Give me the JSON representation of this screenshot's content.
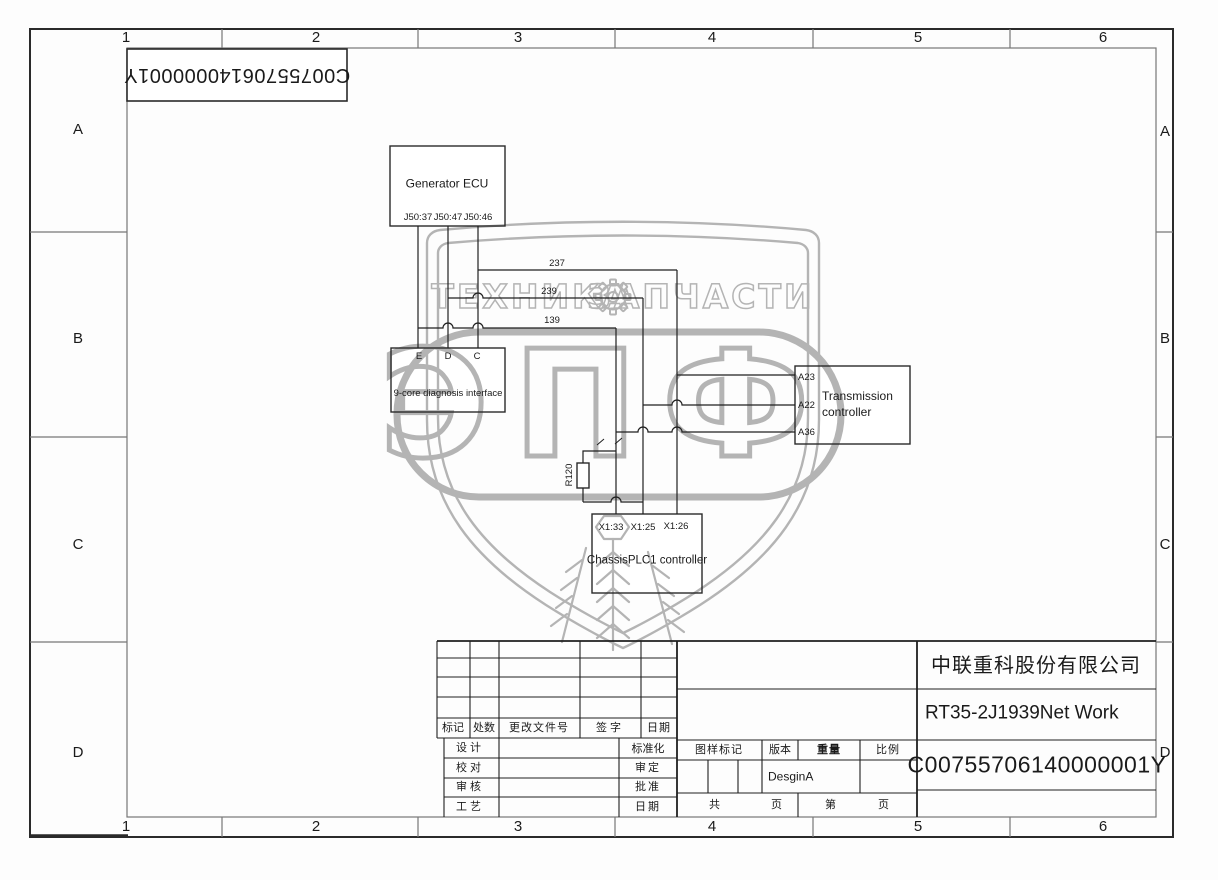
{
  "zones": {
    "cols": [
      "1",
      "2",
      "3",
      "4",
      "5",
      "6"
    ],
    "rows": [
      "A",
      "B",
      "C",
      "D"
    ]
  },
  "corner_ref": "C00755706140000001Y",
  "schematic": {
    "generator_ecu": {
      "title": "Generator ECU",
      "pins": [
        "J50:37",
        "J50:47",
        "J50:46"
      ]
    },
    "diagnosis": {
      "title": "9-core diagnosis interface",
      "pins": [
        "E",
        "D",
        "C"
      ]
    },
    "transmission": {
      "title": "Transmission controller",
      "pins": [
        "A23",
        "A22",
        "A36"
      ]
    },
    "chassis_plc": {
      "title": "ChassisPLC1 controller",
      "pins": [
        "X1:33",
        "X1:25",
        "X1:26"
      ]
    },
    "wire_labels": {
      "w237": "237",
      "w239": "239",
      "w139": "139",
      "resistor": "R120"
    }
  },
  "watermark": {
    "left": "ТЕХНИКА",
    "right": "ЗАПЧАСТИ",
    "center": "ЭПФ"
  },
  "title_block": {
    "revision_header": [
      "标记",
      "处数",
      "更改文件号",
      "签字",
      "日期"
    ],
    "left_rows": [
      "设计",
      "校对",
      "审核",
      "工艺"
    ],
    "mid_rows": [
      "标准化",
      "审定",
      "批准",
      "日期"
    ],
    "stamp_header": [
      "图样标记",
      "版本",
      "重量",
      "比例"
    ],
    "version": "DesginA",
    "pages": [
      "共",
      "页",
      "第",
      "页"
    ],
    "company": "中联重科股份有限公司",
    "title": "RT35-2J1939Net Work",
    "number": "C00755706140000001Y"
  },
  "colors": {
    "ink": "#1a1a1a",
    "frame": "#777777",
    "watermark": "#b4b4b4"
  }
}
